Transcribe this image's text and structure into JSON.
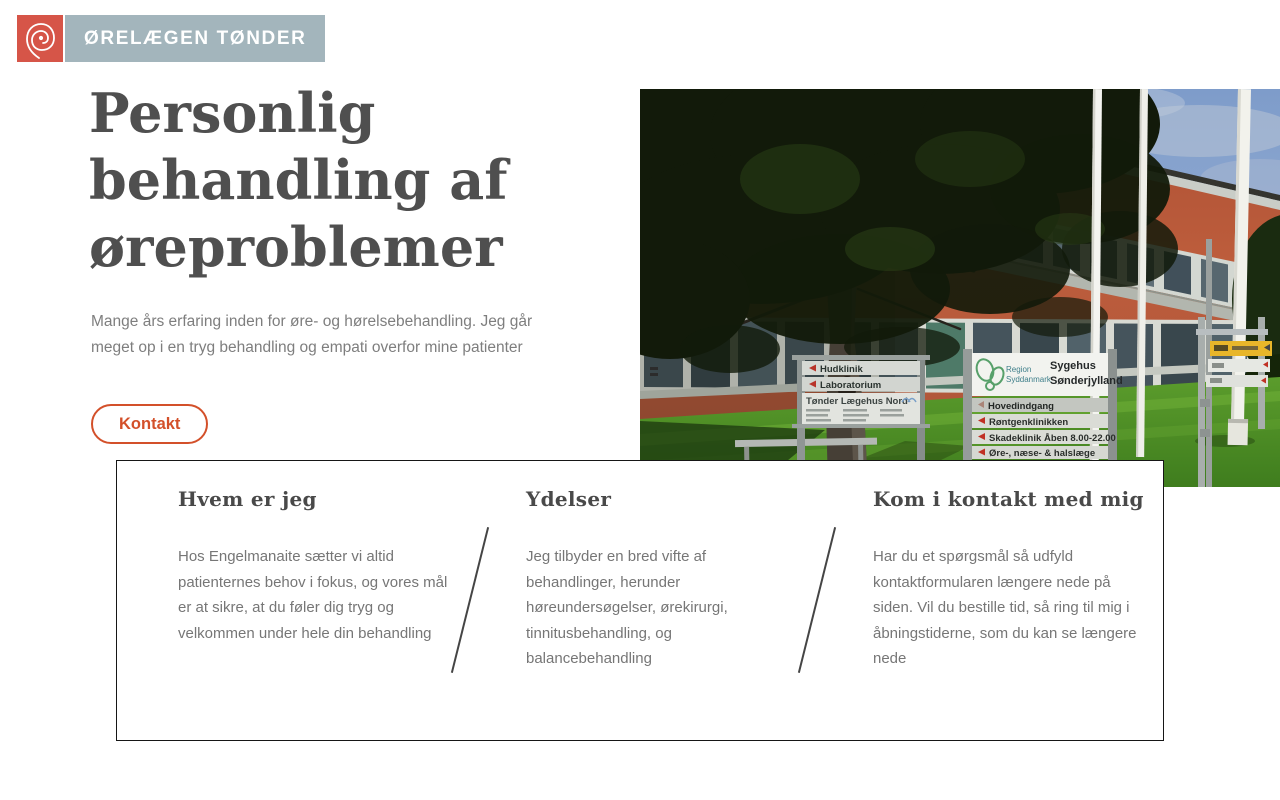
{
  "brand": {
    "name": "ØRELÆGEN TØNDER",
    "logo_red": "#d65548",
    "banner_gray_blue": "#a3b5bc"
  },
  "hero": {
    "title": "Personlig behandling af øreproblemer",
    "description": "Mange års erfaring inden for øre- og hørelsebehandling. Jeg går meget op i en tryg behandling og empati overfor mine patienter",
    "cta_label": "Kontakt",
    "accent_color": "#d3502a"
  },
  "photo": {
    "alt": "Sygehus Sønderjylland hospital building with tree, lawn, flag poles and direction signs",
    "signs": {
      "left": {
        "rows": [
          "Hudklinik",
          "Laboratorium"
        ],
        "title": "Tønder Lægehus Nord"
      },
      "right": {
        "region": [
          "Region",
          "Syddanmark"
        ],
        "hospital": [
          "Sygehus",
          "Sønderjylland"
        ],
        "rows": [
          "Hovedindgang",
          "Røntgenklinikken",
          "Skadeklinik",
          "Øre-, næse- & halslæge",
          "Øjenklinikken"
        ],
        "hours": "Åben 8.00-22.00"
      }
    }
  },
  "cards": [
    {
      "title": "Hvem er jeg",
      "body": "Hos Engelmanaite sætter vi altid patienternes behov i fokus, og vores mål er at sikre, at du føler dig tryg og velkommen under hele din behandling"
    },
    {
      "title": "Ydelser",
      "body": "Jeg tilbyder en bred vifte af behandlinger, herunder høreundersøgelser, ørekirurgi, tinnitusbehandling, og balancebehandling"
    },
    {
      "title": "Kom i kontakt med mig",
      "body": "Har du et spørgsmål så udfyld kontaktformularen længere nede på siden. Vil du bestille tid, så ring til mig i åbningstiderne, som du kan se længere nede"
    }
  ]
}
